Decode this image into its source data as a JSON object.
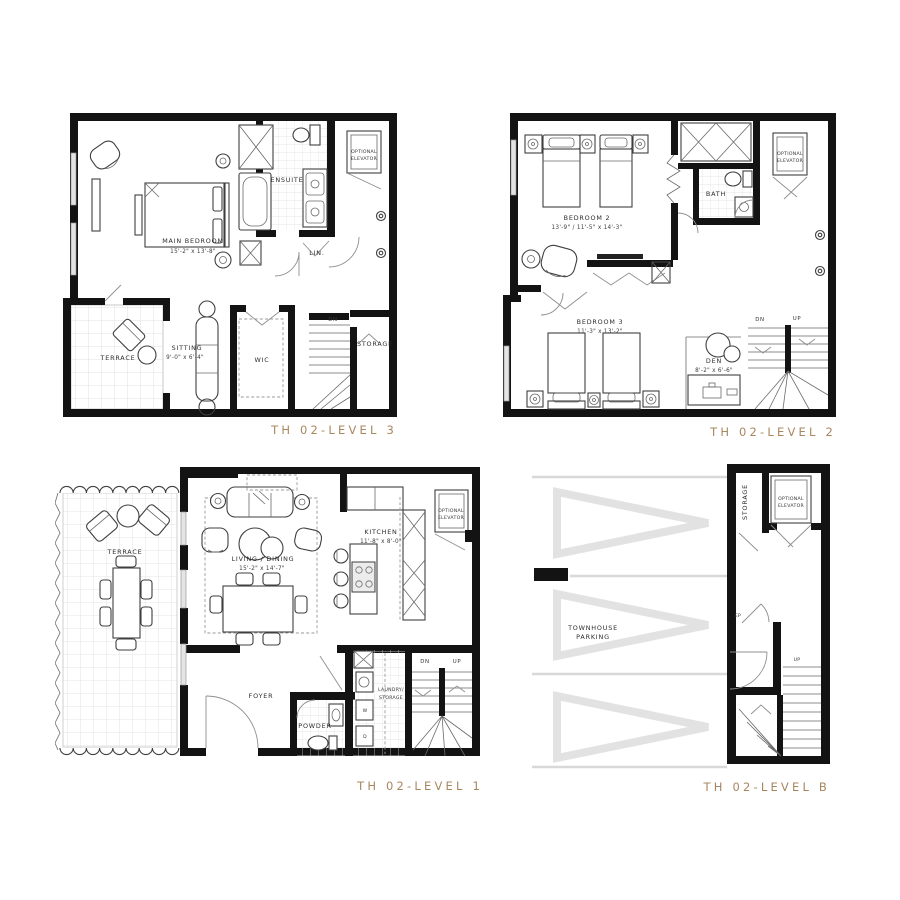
{
  "sheet": {
    "background": "#ffffff",
    "accent_color": "#a8875f",
    "wall_color": "#131313",
    "parking_chevron_color": "#e2e2e2"
  },
  "plans": [
    {
      "id": "th02-level-3",
      "title": "TH 02-LEVEL 3",
      "rooms": {
        "main_bedroom": {
          "name": "MAIN BEDROOM",
          "dims": "15'-2\" x 13'-8\""
        },
        "ensuite": {
          "name": "ENSUITE"
        },
        "linen": {
          "name": "LIN."
        },
        "terrace": {
          "name": "TERRACE"
        },
        "sitting": {
          "name": "SITTING",
          "dims": "9'-0\" x 6'-4\""
        },
        "wic": {
          "name": "WIC"
        },
        "storage": {
          "name": "STORAGE"
        }
      },
      "labels": {
        "elevator_1": "OPTIONAL",
        "elevator_2": "ELEVATOR",
        "dn": "DN"
      }
    },
    {
      "id": "th02-level-2",
      "title": "TH 02-LEVEL 2",
      "rooms": {
        "bedroom2": {
          "name": "BEDROOM 2",
          "dims": "13'-9\" / 11'-5\" x 14'-3\""
        },
        "bedroom3": {
          "name": "BEDROOM 3",
          "dims": "11'-3\" x 13'-2\""
        },
        "bath": {
          "name": "BATH"
        },
        "den": {
          "name": "DEN",
          "dims": "8'-2\" x 6'-6\""
        }
      },
      "labels": {
        "elevator_1": "OPTIONAL",
        "elevator_2": "ELEVATOR",
        "dn": "DN",
        "up": "UP"
      }
    },
    {
      "id": "th02-level-1",
      "title": "TH 02-LEVEL 1",
      "rooms": {
        "terrace": {
          "name": "TERRACE"
        },
        "living_dining": {
          "name": "LIVING / DINING",
          "dims": "15'-2\" x 14'-7\""
        },
        "kitchen": {
          "name": "KITCHEN",
          "dims": "11'-8\" x 8'-0\""
        },
        "foyer": {
          "name": "FOYER"
        },
        "powder": {
          "name": "POWDER"
        },
        "laundry_1": "LAUNDRY/",
        "laundry_2": "STORAGE"
      },
      "labels": {
        "elevator_1": "OPTIONAL",
        "elevator_2": "ELEVATOR",
        "dn": "DN",
        "up": "UP",
        "washer": "W",
        "dryer": "D"
      }
    },
    {
      "id": "th02-level-b",
      "title": "TH 02-LEVEL B",
      "rooms": {
        "parking_1": "TOWNHOUSE",
        "parking_2": "PARKING",
        "storage": {
          "name": "STORAGE"
        }
      },
      "labels": {
        "elevator_1": "OPTIONAL",
        "elevator_2": "ELEVATOR",
        "up": "UP",
        "ep": "EP"
      }
    }
  ]
}
